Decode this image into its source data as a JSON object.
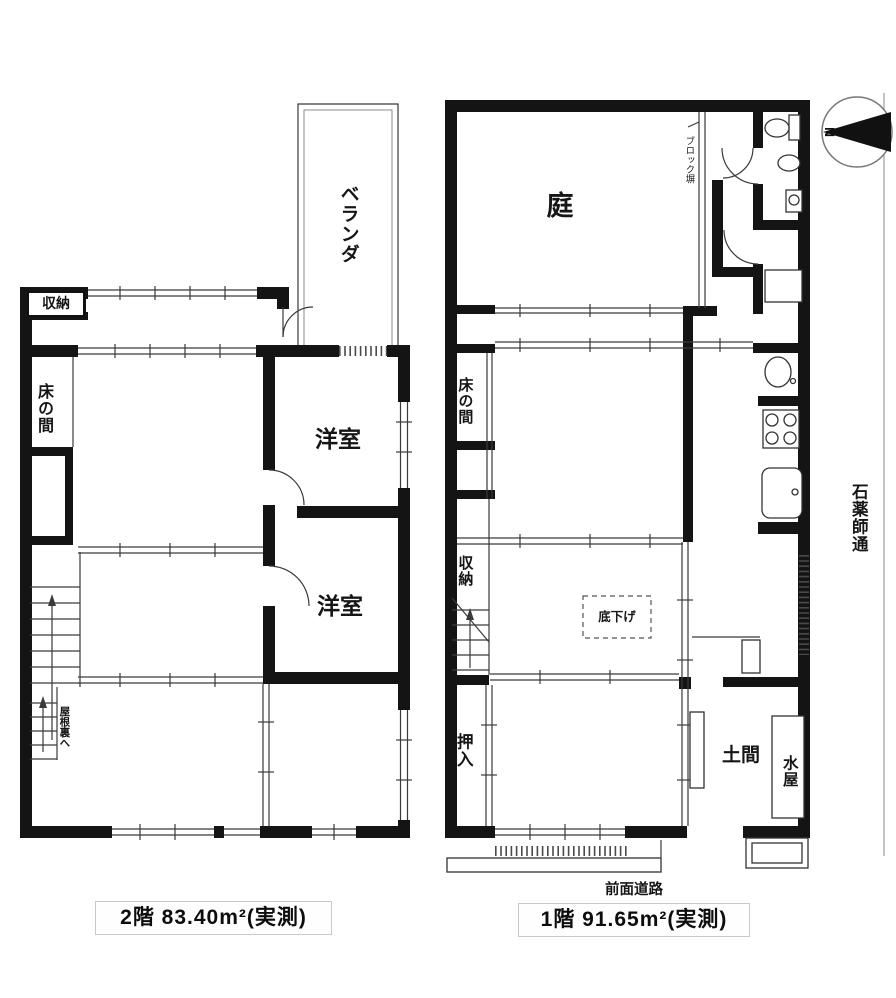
{
  "colors": {
    "wall": "#141414",
    "thin_line": "#3a3a3a",
    "caption_border": "#c9c9c9",
    "background": "#ffffff"
  },
  "compass": {
    "label": "N"
  },
  "street": {
    "name": "石薬師通"
  },
  "floor2": {
    "caption": "2階 83.40m²(実測)",
    "rooms": {
      "veranda": "ベランダ",
      "storage": "収納",
      "tokonoma": "床の間",
      "western_upper": "洋室",
      "western_lower": "洋室",
      "to_attic": "屋根裏へ"
    }
  },
  "floor1": {
    "caption": "1階 91.65m²(実測)",
    "front_road": "前面道路",
    "rooms": {
      "garden": "庭",
      "block_wall": "ブロック塀",
      "tokonoma": "床の間",
      "storage": "収納",
      "closet": "押入",
      "lowered_floor": "底下げ",
      "doma": "土間",
      "mizuya": "水屋"
    }
  }
}
